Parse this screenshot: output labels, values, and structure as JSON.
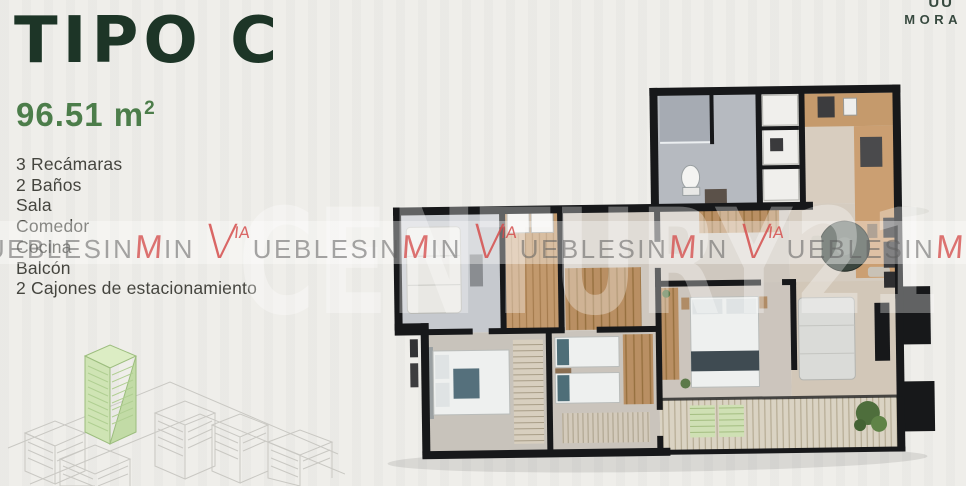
{
  "header": {
    "title": "TIPO C",
    "area": "96.51 m",
    "area_sup": "2"
  },
  "features": [
    "3 Recámaras",
    "2 Baños",
    "Sala",
    "Comedor",
    "Cocina",
    "Balcón",
    "2 Cajones de estacionamiento"
  ],
  "brand": {
    "partial_glyphs": "UU",
    "name": "MORA"
  },
  "watermark": {
    "logo_v": "V",
    "logo_sup": "IA",
    "text_a": "UEBLESIN",
    "logo_m": "M",
    "text_b": "IN",
    "repeat": 5,
    "giant": "CENTURY21"
  },
  "colors": {
    "title_green": "#1d3527",
    "area_green": "#4c7d4a",
    "feature_gray": "#45453f",
    "watermark_red": "#d54d4c",
    "highlight_building_green": "#d3e6ba",
    "wall_black": "#17181a"
  }
}
